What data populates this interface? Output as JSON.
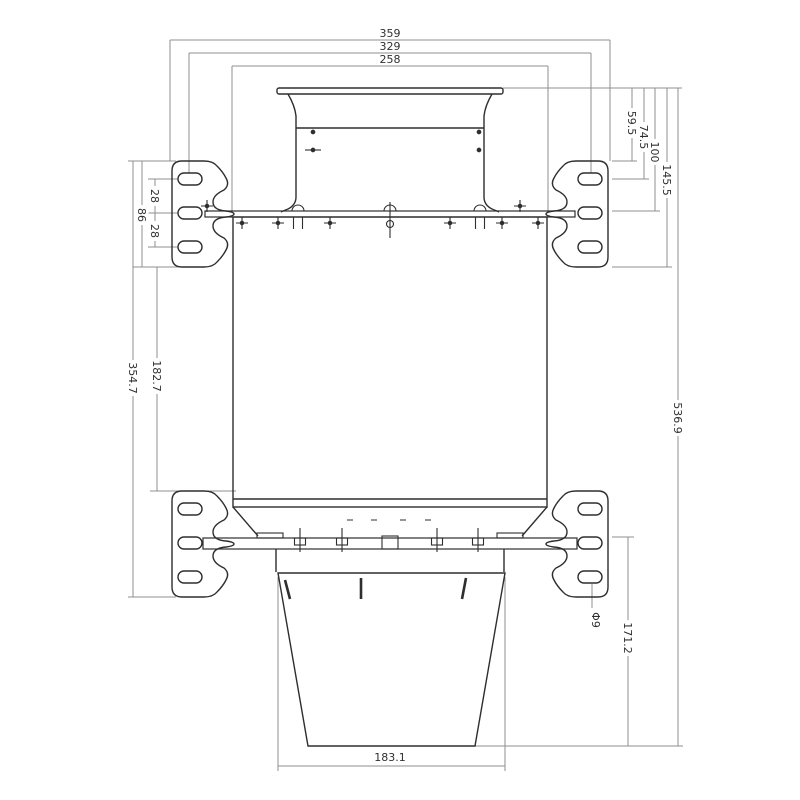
{
  "drawing": {
    "dims": {
      "overall_width": "359",
      "slot_center_width": "329",
      "flange_width": "258",
      "top_to_bracket_top": "59.5",
      "top_to_upper_slot": "74.5",
      "top_to_rail": "100",
      "top_to_bracket_bottom": "145.5",
      "overall_height": "536.9",
      "slot_pitch_upper": "28",
      "bracket_height": "86",
      "slot_pitch_lower": "28",
      "bracket_gap": "182.7",
      "bracket_span": "354.7",
      "rail_to_bottom": "171.2",
      "hole_diameter": "Φ9",
      "bucket_width": "183.1"
    }
  }
}
